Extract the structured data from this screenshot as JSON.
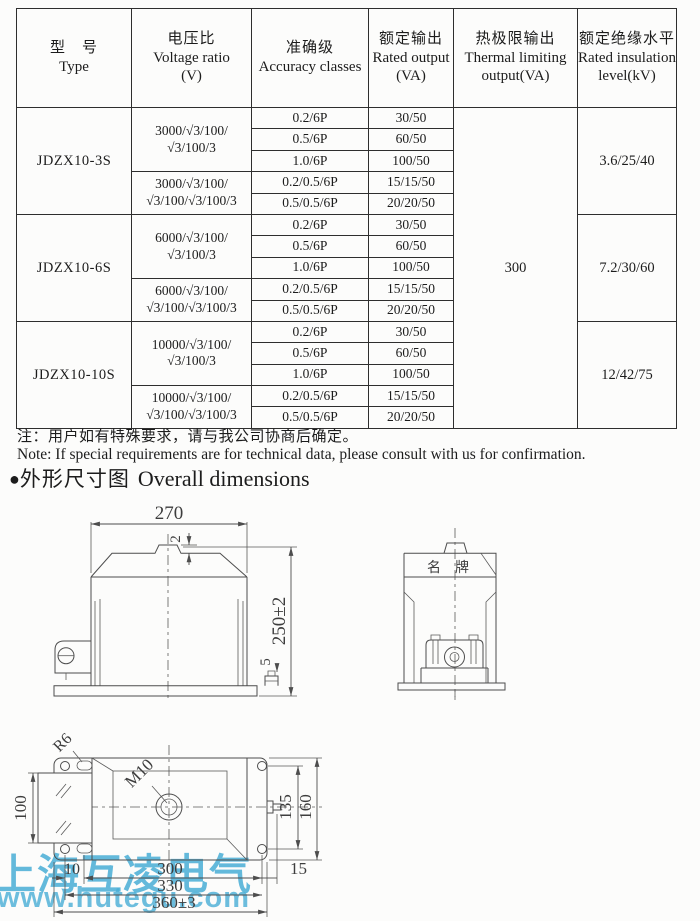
{
  "table": {
    "headers": {
      "type": [
        "型　号",
        "Type"
      ],
      "voltage": [
        "电压比",
        "Voltage ratio",
        "(V)"
      ],
      "accuracy": [
        "准确级",
        "Accuracy classes"
      ],
      "rated": [
        "额定输出",
        "Rated output",
        "(VA)"
      ],
      "thermal": [
        "热极限输出",
        "Thermal limiting",
        "output(VA)"
      ],
      "insulation": [
        "额定绝缘水平",
        "Rated insulation",
        "level(kV)"
      ]
    },
    "thermal_value": "300",
    "groups": [
      {
        "type": "JDZX10-3S",
        "insulation": "3.6/25/40",
        "ratios": [
          {
            "lines": [
              "3000/√3/100/",
              "√3/100/3"
            ],
            "rows": [
              [
                "0.2/6P",
                "30/50"
              ],
              [
                "0.5/6P",
                "60/50"
              ],
              [
                "1.0/6P",
                "100/50"
              ]
            ]
          },
          {
            "lines": [
              "3000/√3/100/",
              "√3/100/√3/100/3"
            ],
            "rows": [
              [
                "0.2/0.5/6P",
                "15/15/50"
              ],
              [
                "0.5/0.5/6P",
                "20/20/50"
              ]
            ]
          }
        ]
      },
      {
        "type": "JDZX10-6S",
        "insulation": "7.2/30/60",
        "ratios": [
          {
            "lines": [
              "6000/√3/100/",
              "√3/100/3"
            ],
            "rows": [
              [
                "0.2/6P",
                "30/50"
              ],
              [
                "0.5/6P",
                "60/50"
              ],
              [
                "1.0/6P",
                "100/50"
              ]
            ]
          },
          {
            "lines": [
              "6000/√3/100/",
              "√3/100/√3/100/3"
            ],
            "rows": [
              [
                "0.2/0.5/6P",
                "15/15/50"
              ],
              [
                "0.5/0.5/6P",
                "20/20/50"
              ]
            ]
          }
        ]
      },
      {
        "type": "JDZX10-10S",
        "insulation": "12/42/75",
        "ratios": [
          {
            "lines": [
              "10000/√3/100/",
              "√3/100/3"
            ],
            "rows": [
              [
                "0.2/6P",
                "30/50"
              ],
              [
                "0.5/6P",
                "60/50"
              ],
              [
                "1.0/6P",
                "100/50"
              ]
            ]
          },
          {
            "lines": [
              "10000/√3/100/",
              "√3/100/√3/100/3"
            ],
            "rows": [
              [
                "0.2/0.5/6P",
                "15/15/50"
              ],
              [
                "0.5/0.5/6P",
                "20/20/50"
              ]
            ]
          }
        ]
      }
    ]
  },
  "notes": {
    "zh": "注：用户如有特殊要求，请与我公司协商后确定。",
    "en": "Note: If special requirements are for technical data, please consult with us for confirmation."
  },
  "section": {
    "bullet": "●",
    "zh": "外形尺寸图",
    "en": "Overall dimensions"
  },
  "dims": {
    "front": {
      "width": "270",
      "cap": "2",
      "height": "250±2",
      "base_bolt": "5"
    },
    "side": {
      "nameplate": "名牌"
    },
    "bottom": {
      "slot_radius": "R6",
      "thread": "M10",
      "left_height": "100",
      "right_inner": "135",
      "right_outer": "160",
      "off_left": "10",
      "span": "300",
      "off_right": "15",
      "holes_span": "330",
      "total": "360±3"
    }
  },
  "watermark": {
    "line1": "上海互凌电气",
    "line2": "www.hutegu.com",
    "color": "#49aed6"
  }
}
